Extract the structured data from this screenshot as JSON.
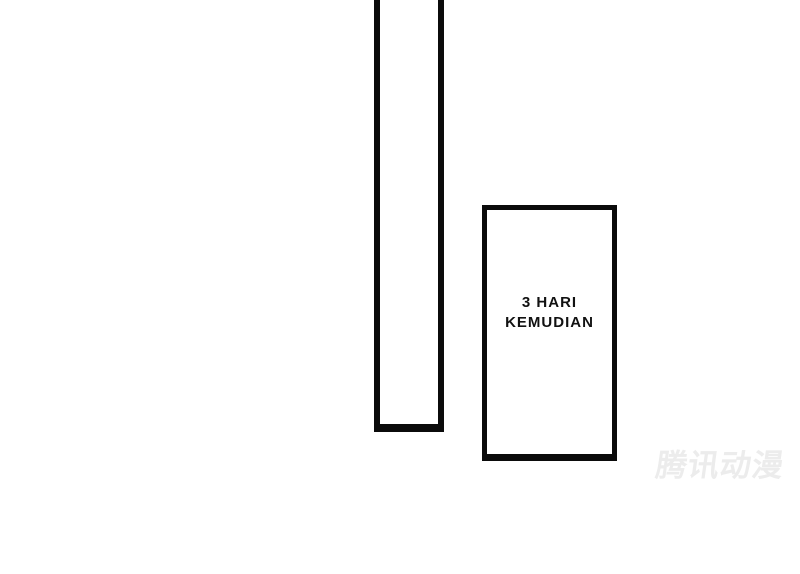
{
  "page": {
    "background_color": "#ffffff",
    "panel_border_color": "#0b0b0b",
    "text_color": "#111111"
  },
  "panels": {
    "tall_panel": {
      "content": ""
    },
    "caption_panel": {
      "line1": "3 HARI",
      "line2": "KEMUDIAN"
    }
  },
  "watermark": {
    "text": "腾讯动漫",
    "color": "#ececec"
  }
}
